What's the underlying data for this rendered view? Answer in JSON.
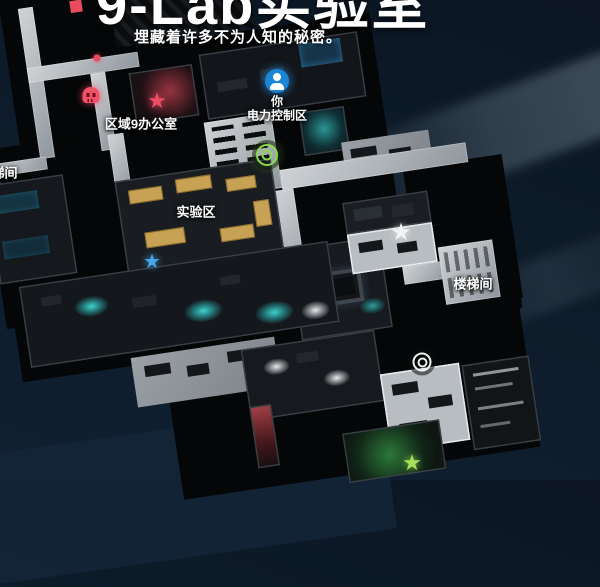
{
  "header": {
    "title": "9-Lab实验室",
    "subtitle": "埋藏着许多不为人知的秘密。"
  },
  "map": {
    "player": {
      "name_label": "你",
      "area_label": "电力控制区"
    },
    "labels": {
      "area9_office": "区域9办公室",
      "lab_zone": "实验区",
      "stairwell_left": "楼梯间",
      "stairwell_right": "楼梯间"
    },
    "markers": [
      "player-position",
      "enemy-skull",
      "enemy-red-star",
      "blue-star",
      "white-star",
      "green-star",
      "objective-green-bullseye",
      "objective-white-bullseye",
      "small-red-dot"
    ]
  },
  "colors": {
    "background_navy": "#0e1c2b",
    "player_blue": "#1b86d6",
    "enemy_red": "#ef4d63",
    "objective_green": "#8cd94e",
    "objective_white": "#eef0f0",
    "star_blue": "#4aa8e8",
    "bench_tan": "#c7a254",
    "glow_cyan": "#3ad2cc"
  }
}
